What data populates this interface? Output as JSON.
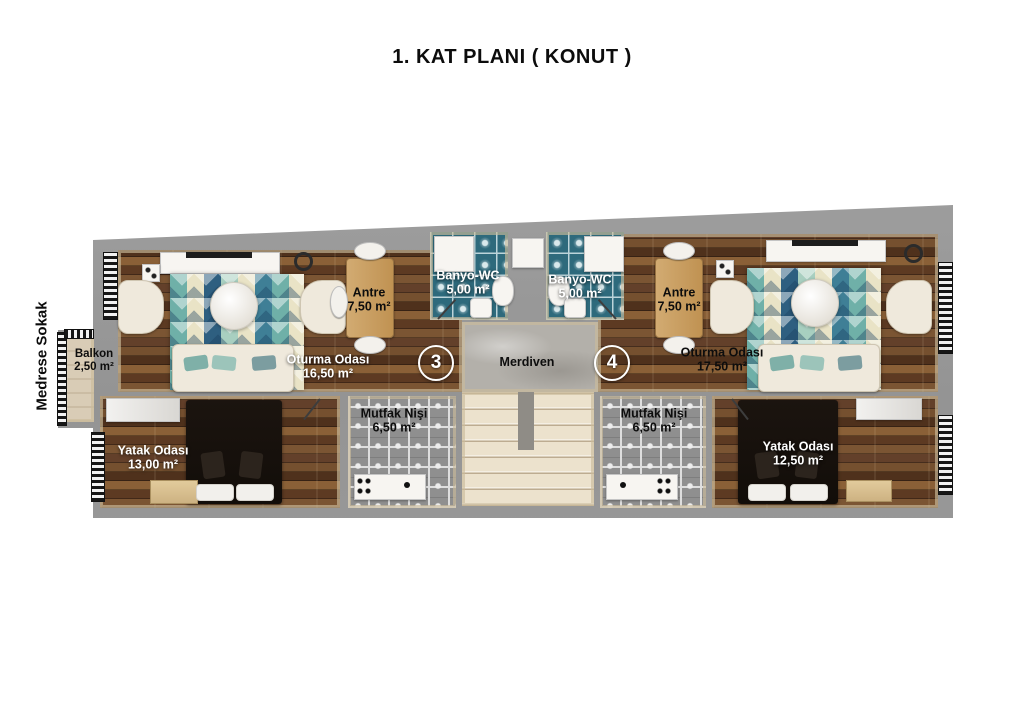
{
  "page": {
    "title": "1. KAT PLANI ( KONUT )",
    "street": "Medrese Sokak"
  },
  "plan": {
    "stairs": {
      "label": "Merdiven"
    },
    "units": [
      {
        "badge": "3"
      },
      {
        "badge": "4"
      }
    ],
    "rooms": {
      "balkon": {
        "name": "Balkon",
        "area": "2,50 m²"
      },
      "oturma_sol": {
        "name": "Oturma Odası",
        "area": "16,50 m²"
      },
      "antre_sol": {
        "name": "Antre",
        "area": "7,50 m²"
      },
      "banyo_sol": {
        "name": "Banyo-WC",
        "area": "5,00 m²"
      },
      "banyo_sag": {
        "name": "Banyo-WC",
        "area": "5,00 m²"
      },
      "antre_sag": {
        "name": "Antre",
        "area": "7,50 m²"
      },
      "oturma_sag": {
        "name": "Oturma Odası",
        "area": "17,50 m²"
      },
      "mutfak_sol": {
        "name": "Mutfak Nişi",
        "area": "6,50 m²"
      },
      "mutfak_sag": {
        "name": "Mutfak Nişi",
        "area": "6,50 m²"
      },
      "yatak_sol": {
        "name": "Yatak Odası",
        "area": "13,00 m²"
      },
      "yatak_sag": {
        "name": "Yatak Odası",
        "area": "12,50 m²"
      }
    },
    "colors": {
      "wall": "#9c9c9c",
      "trim": "#cdbf9e",
      "wood": "#6a452a",
      "bath_tile": "#2e6a7c",
      "kitchen_tile": "#8f8f8f",
      "stair": "#ece2cd",
      "hall_marble": "#b3b0aa",
      "rug_teal": "#7fb7ae",
      "rug_navy": "#2e5f80",
      "rug_cream": "#e9e3c6"
    }
  }
}
